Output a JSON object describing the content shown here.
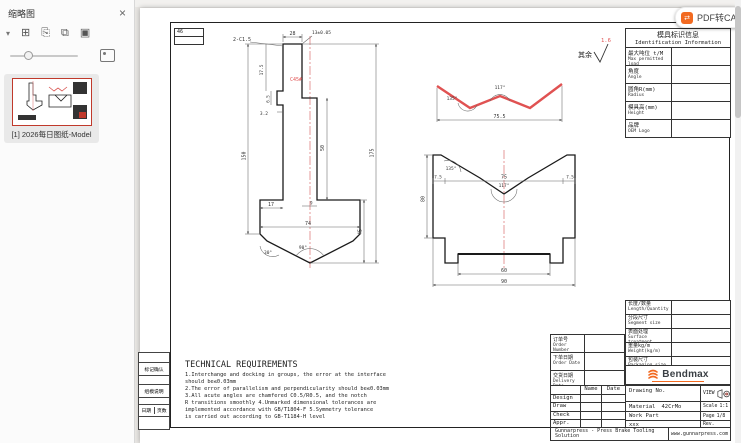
{
  "sidebar": {
    "title": "缩略图",
    "close_label": "×",
    "toolbar_icons": [
      {
        "name": "chevron-down-icon",
        "glyph": "▾"
      },
      {
        "name": "insert-page-icon",
        "glyph": "⊞"
      },
      {
        "name": "copy-page-icon",
        "glyph": "⎘"
      },
      {
        "name": "duplicate-page-icon",
        "glyph": "⧉"
      },
      {
        "name": "extract-page-icon",
        "glyph": "▣"
      }
    ],
    "thumbnail_label": "[1] 2026每日图纸-Model"
  },
  "viewer": {
    "pdf2cad_button": "PDF转CAD"
  },
  "sheet": {
    "surface_note": {
      "prefix": "其余",
      "roughness": "1.6"
    },
    "corner_note": "46",
    "id_table": {
      "title_zh": "模具标识信息",
      "title_en": "Identification Information",
      "rows": [
        {
          "zh": "最大吨位 t/M",
          "en": "Max permitted load"
        },
        {
          "zh": "角度",
          "en": "Angle"
        },
        {
          "zh": "圆角R(mm)",
          "en": "Radius"
        },
        {
          "zh": "模具高(mm)",
          "en": "Height"
        },
        {
          "zh": "品牌",
          "en": "OEM Logo"
        }
      ]
    },
    "spec_table": {
      "rows": [
        {
          "zh": "长度/数量",
          "en": "Length/Quantity"
        },
        {
          "zh": "分段尺寸",
          "en": "Segment size"
        },
        {
          "zh": "表面处理",
          "en": "Surface treatment"
        },
        {
          "zh": "重量kg/m",
          "en": "Weight(kg/m)"
        },
        {
          "zh": "包装尺寸",
          "en": "Packaging size"
        }
      ]
    },
    "order_table": {
      "rows": [
        {
          "zh": "订单号",
          "en": "Order Number"
        },
        {
          "zh": "下单日期",
          "en": "Order Date"
        },
        {
          "zh": "交货日期",
          "en": "Delivery Date"
        }
      ]
    },
    "margin_table": {
      "row1": "标记确认",
      "row2": "组模说明",
      "row3a": "日期",
      "row3b": "页数"
    },
    "tech": {
      "title": "TECHNICAL REQUIREMENTS",
      "body": "1.Interchange and docking in groups, the error at the interface\nshould be≤0.03mm\n2.The error of parallelism and perpendicularity should be≤0.03mm\n3.All acute angles are chamfered C0.5/R0.5, and the notch\nR transitions smoothly 4.Unmarked dimensional tolerances are\nimplemented accordance with GB/T1804-F 5.Symmetry tolerance\nis carried out according to GB-T1184-H level"
    },
    "title_block": {
      "brand": "Bendmax",
      "sign_header": {
        "name": "Name",
        "date": "Date"
      },
      "sign_rows": [
        "Design",
        "Draw",
        "Check",
        "Appr."
      ],
      "drawing_no_label": "Drawing No.",
      "material_label": "Material",
      "material_value": "42CrMo",
      "work_part_label": "Work Part",
      "note": "xxx",
      "view_label": "VIEW",
      "scale_label": "Scale",
      "scale_value": "1:1",
      "page_label": "Page",
      "page_value": "1/8",
      "rev_label": "Rev.",
      "footer_left": "Gunnarpress - Press Brake Tooling Solution",
      "footer_right": "www.gunnarpress.com"
    },
    "punch": {
      "red_mark": "C45#",
      "dims": {
        "top_width": "28",
        "chamfer": "2-C1.5",
        "tol": "13±0.05",
        "shank_h": "17.5",
        "groove_h": "6.5",
        "groove_d": "3.2",
        "right_h": "50",
        "total_h": "175",
        "left_h": "150",
        "shoulder": "17",
        "step": "9",
        "body_w": "74",
        "body_h": "45",
        "angle_side": "30°",
        "angle_tip": "90°"
      }
    },
    "profile": {
      "dims": {
        "width": "75.5",
        "angle_left": "135°",
        "angle_center": "117°"
      }
    },
    "die": {
      "dims": {
        "lip_l": "7.5",
        "opening": "75",
        "lip_r": "7.5",
        "angle_entry": "135°",
        "angle_v": "117°",
        "height": "80",
        "slot": "60",
        "base": "90"
      }
    }
  },
  "colors": {
    "accent_orange": "#f26a21",
    "dim_red": "#e05252"
  }
}
